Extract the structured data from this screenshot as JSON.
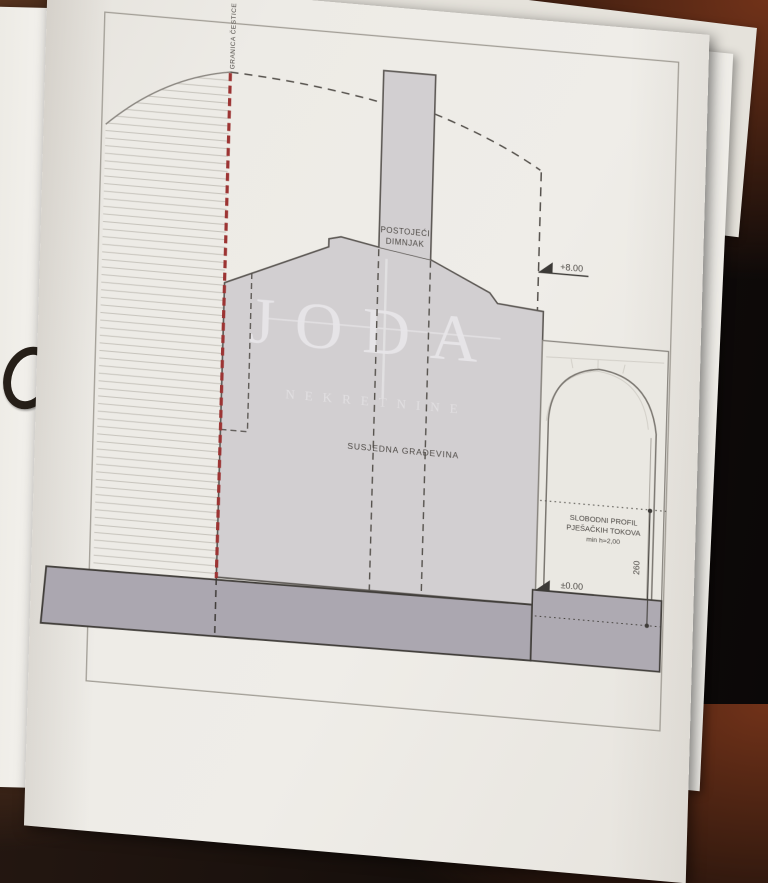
{
  "labels": {
    "boundary": "GRANICA ČESTICE",
    "chimney_l1": "POSTOJEĆI",
    "chimney_l2": "DIMNJAK",
    "neighbor": "SUSJEDNA GRAĐEVINA",
    "level_top": "+8.00",
    "level_zero": "±0.00",
    "profile_l1": "SLOBODNI PROFIL",
    "profile_l2": "PJEŠAČKIH TOKOVA",
    "profile_l3": "min h=2,00",
    "dim": "260"
  },
  "watermark": {
    "word": "JODA",
    "subtitle": "NEKRETNINE"
  },
  "colors": {
    "boundary_red": "#9c3433",
    "building_gray": "#d2cfd1",
    "ground_gray": "#aba7b0",
    "sidewalk_gray": "#aeaab2",
    "line_dark": "#56524d",
    "page": "#edebe6"
  }
}
